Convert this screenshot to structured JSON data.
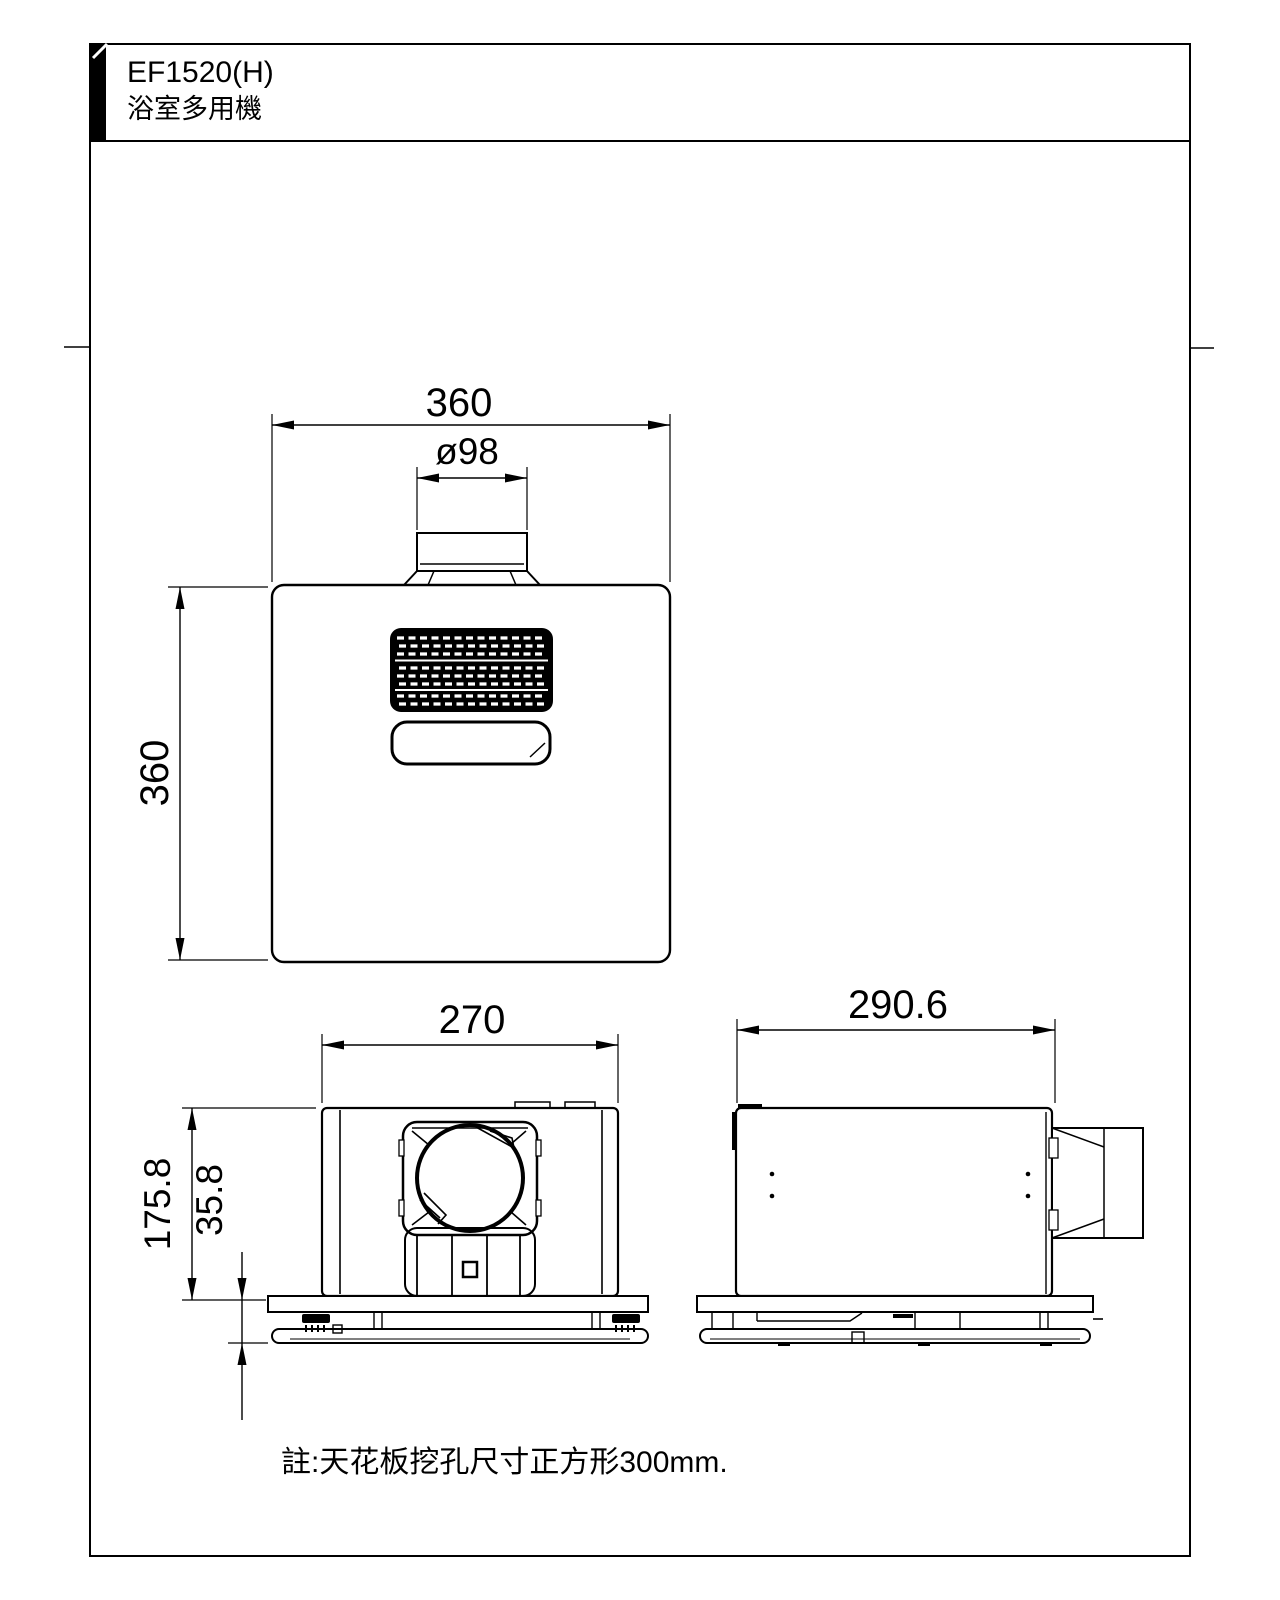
{
  "title_block": {
    "model": "EF1520(H)",
    "product_name": "浴室多用機"
  },
  "dimensions": {
    "top_view_width": "360",
    "top_view_height": "360",
    "duct_diameter": "ø98",
    "front_view_width": "270",
    "unit_height": "175.8",
    "panel_height": "35.8",
    "side_view_depth": "290.6"
  },
  "note": "註:天花板挖孔尺寸正方形300mm.",
  "colors": {
    "line": "#000000",
    "background": "#ffffff"
  }
}
